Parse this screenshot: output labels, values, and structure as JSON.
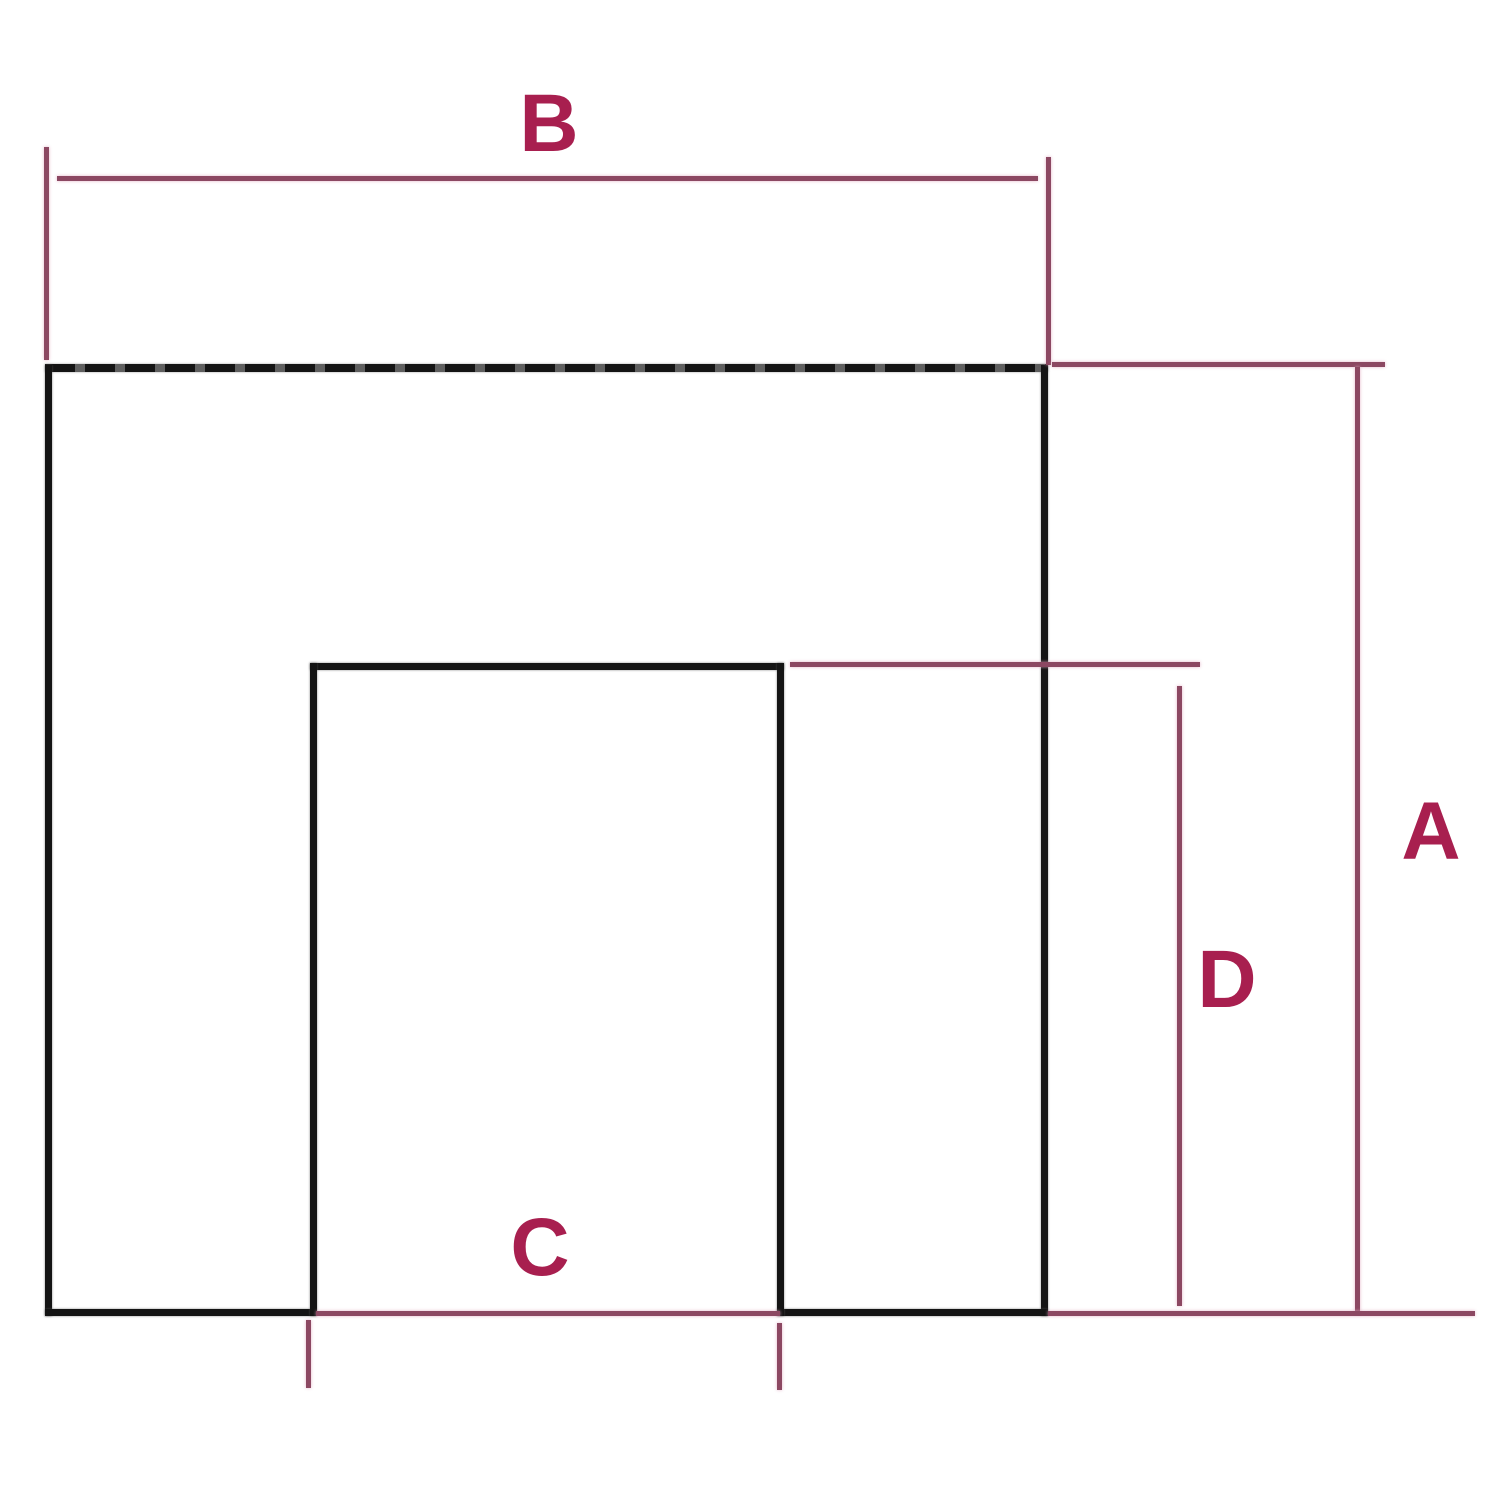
{
  "diagram": {
    "type": "dimension-diagram",
    "shape": "square frame with dashed top edge and inner bottom opening",
    "labels": {
      "a": "A",
      "b": "B",
      "c": "C",
      "d": "D"
    },
    "label_meanings": {
      "a": "overall height (right side vertical dimension)",
      "b": "overall width (top horizontal dimension)",
      "c": "opening width (bottom horizontal dimension)",
      "d": "opening height (inner vertical dimension)"
    },
    "colors": {
      "outline": "#141414",
      "dimension_line": "#8c4862",
      "label_text": "#a81f4f",
      "background": "#ffffff"
    }
  }
}
